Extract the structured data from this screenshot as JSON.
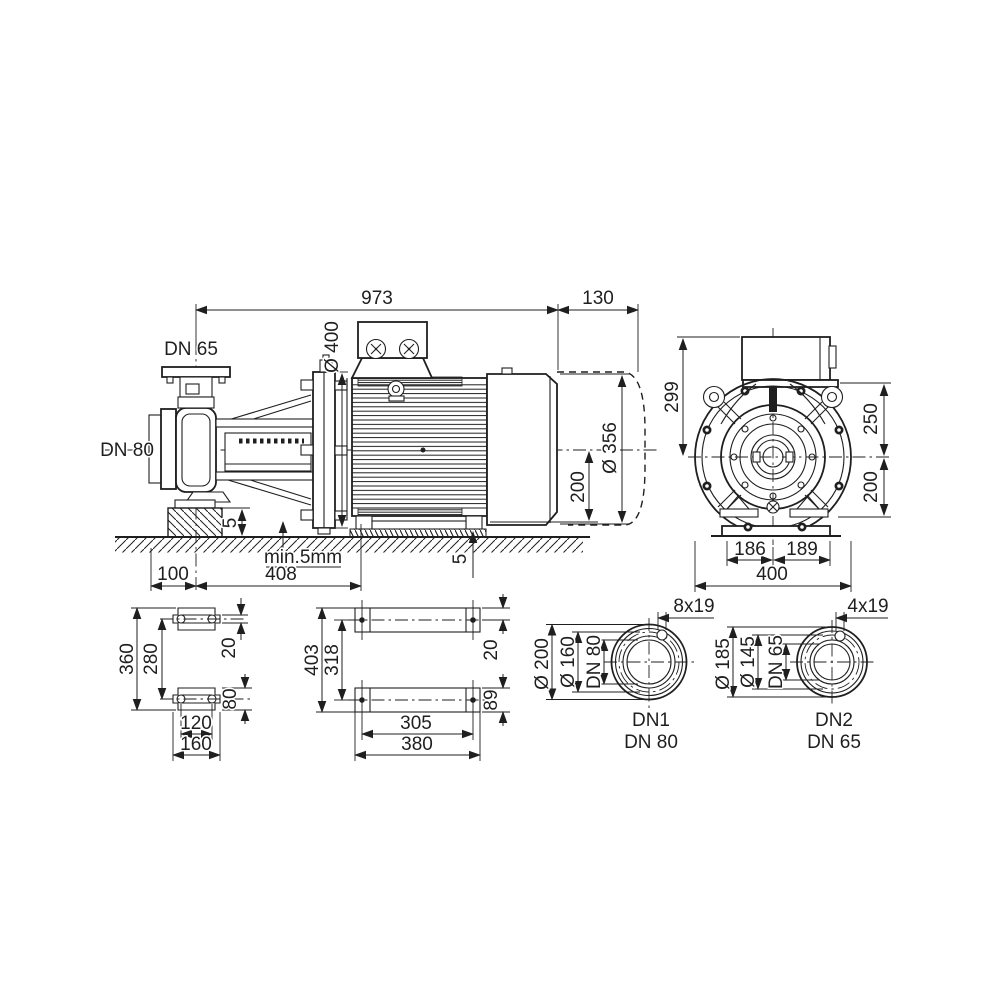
{
  "drawing_type": "pump-dimensional-drawing",
  "side": {
    "total_length": "973",
    "fan_clearance": "130",
    "discharge_nozzle": "DN 65",
    "suction_nozzle": "DN 80",
    "flange_od": "Ø 400",
    "motor_od": "Ø 356",
    "shaft_height": "200",
    "pump_shim": "5",
    "motor_shim": "5",
    "grout_note": "min.5mm",
    "suction_offset": "100",
    "pump_length": "408"
  },
  "front": {
    "height_above_axis": "299",
    "box_to_axis": "250",
    "axis_to_base": "200",
    "foot_left": "186",
    "foot_right": "189",
    "base_width": "400"
  },
  "pump_feet_plan": {
    "total_length": "360",
    "hole_pitch": "280",
    "slot_width": "20",
    "foot_width": "80",
    "hole_pitch_cross": "120",
    "plate_width": "160"
  },
  "motor_feet_plan": {
    "total_length": "403",
    "hole_pitch": "318",
    "edge_to_hole": "20",
    "plate_depth": "89",
    "hole_pitch_cross": "305",
    "plate_length": "380"
  },
  "flange_dn1": {
    "bolt_holes": "8x19",
    "outer_diameter": "Ø 200",
    "bolt_circle": "Ø 160",
    "bore": "DN 80",
    "port_label": "DN1",
    "port_size": "DN 80"
  },
  "flange_dn2": {
    "bolt_holes": "4x19",
    "outer_diameter": "Ø 185",
    "bolt_circle": "Ø 145",
    "bore": "DN 65",
    "port_label": "DN2",
    "port_size": "DN 65"
  }
}
